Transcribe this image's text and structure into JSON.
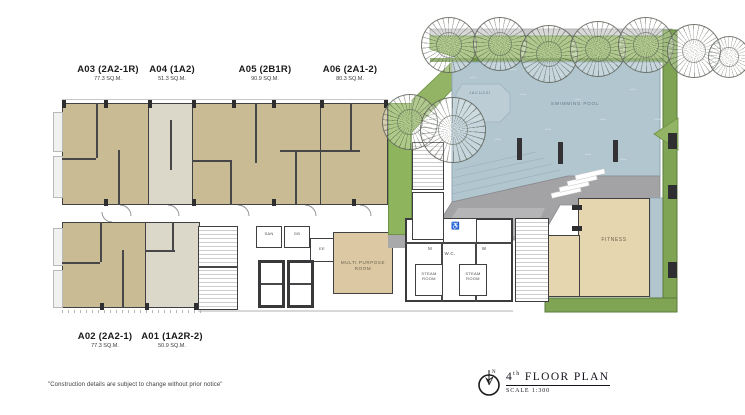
{
  "top_units": [
    {
      "code": "A03 (2A2-1R)",
      "area": "77.3 SQ.M."
    },
    {
      "code": "A04 (1A2)",
      "area": "51.3 SQ.M."
    },
    {
      "code": "A05 (2B1R)",
      "area": "90.9 SQ.M."
    },
    {
      "code": "A06 (2A1-2)",
      "area": "80.3 SQ.M."
    }
  ],
  "bottom_units": [
    {
      "code": "A02 (2A2-1)",
      "area": "77.3 SQ.M."
    },
    {
      "code": "A01 (1A2R-2)",
      "area": "50.9 SQ.M."
    }
  ],
  "plan_labels": {
    "jacuzzi": "JACUZZI",
    "swimming_pool": "SWIMMING POOL",
    "fitness": "FITNESS",
    "multi_purpose": "MULTI PURPOSE\nROOM",
    "mens": "M",
    "womens": "W",
    "wc": "W.C.",
    "steam_room": "STEAM\nROOM",
    "san": "SAN",
    "gb": "GB",
    "ee": "EE",
    "accessible_icon": "♿"
  },
  "title_block": {
    "floor_number": "4",
    "floor_suffix": "th",
    "title_rest": " FLOOR PLAN",
    "scale": "SCALE 1:300",
    "north_letter": "N"
  },
  "footer": {
    "disclaimer": "\"Construction details are subject to change without prior notice\""
  },
  "colors": {
    "unit_tan": "#c9bb94",
    "unit_light": "#dcd8c9",
    "fitness_tan": "#e6d6b0",
    "pool_blue": "#b2c6d0",
    "landscape_green": "#93b464",
    "deck_gray": "#a3a3a5",
    "wall_dark": "#414143"
  }
}
